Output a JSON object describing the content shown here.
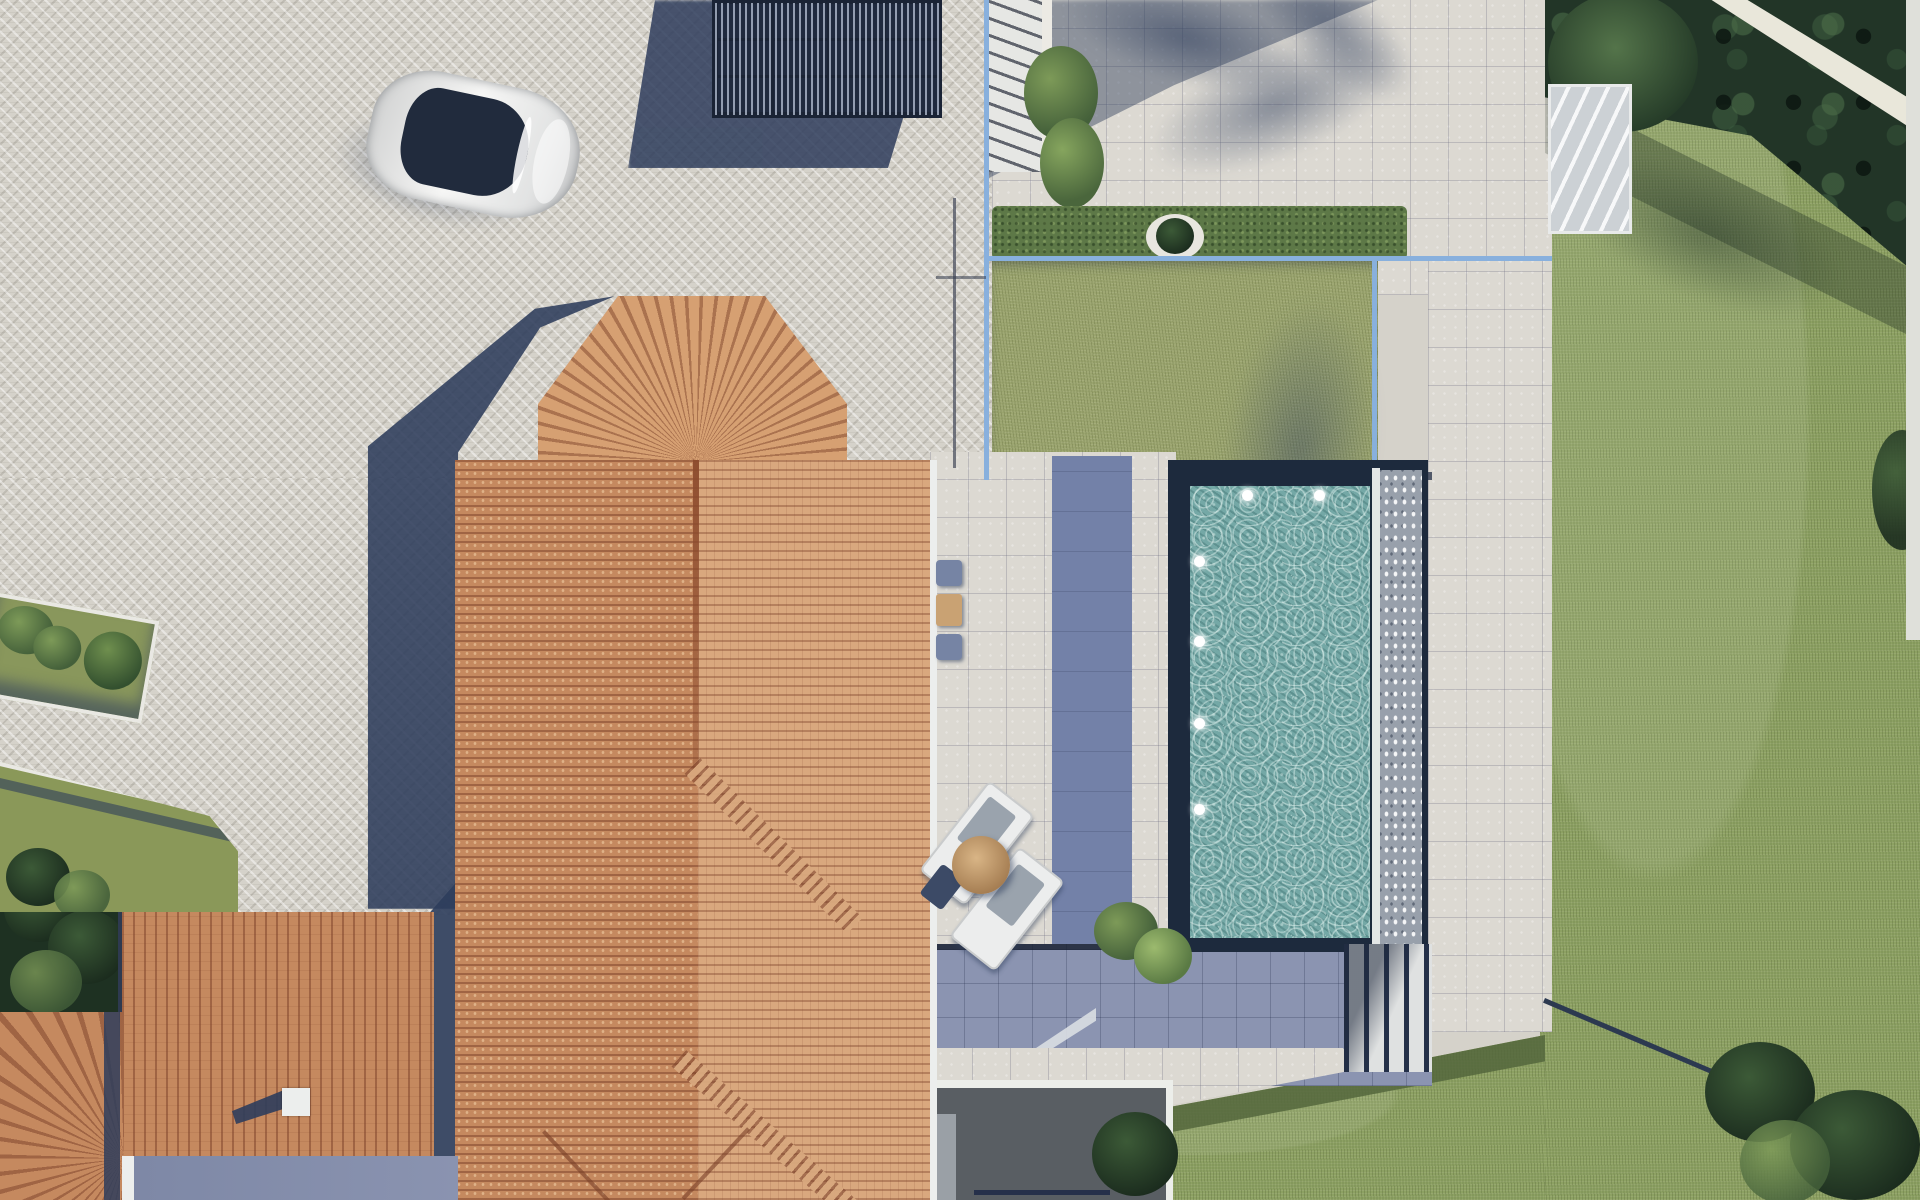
{
  "meta": {
    "type": "aerial-architectural-render",
    "view": "top-down bird's-eye plan view",
    "description": "Top-down 3D rendering of a Mediterranean villa: terracotta hip roofs with an octagonal bay, herringbone stone-paver driveway with a parked white car, a dark slatted rooftop pergola, upper tiled terrace behind a light-blue glass balustrade, central lawn, dark-framed lap pool with white underwater lights and an overflow deck, blue-grey lower terrace with sun loungers and a parasol, white garden stairs, surrounding lawns, clipped hedges, palm-tree shadows and a dense tree line along the right boundary.",
    "dimensions": {
      "width": 1920,
      "height": 1200
    }
  },
  "palette": {
    "paver": "#d5d2ca",
    "tile": "#dcd9d2",
    "grass": "#8da163",
    "lawn": "#9aa46e",
    "grass-dark": "#6f8150",
    "trees": "#223527",
    "hedge": "#5d7847",
    "roof": "#c5895f",
    "roof-light": "#d9a87e",
    "roof-rib": "#7a3f28",
    "pool-water": "#74a8a6",
    "pool-frame": "#1d2a3d",
    "fence": "#88b0dd",
    "terrace-blue": "#8b94b1",
    "deck-band": "#7381a8",
    "shadow": "#2e3d5c",
    "car-body": "#ebecec",
    "car-glass": "#212b3d",
    "pergola-dark": "#1f293e",
    "pergola-slat": "#97a2b8",
    "white": "#eceeed",
    "courtyard": "#595e63",
    "sand": "#c9a273"
  },
  "objects": {
    "scene": {
      "label": "Aerial view of a villa with pool, terraces and gardens"
    },
    "driveway": {
      "label": "Herringbone paver driveway"
    },
    "car": {
      "label": "White car parked on the driveway"
    },
    "pergola": {
      "label": "Dark slatted pergola / solar canopy"
    },
    "main_roof": {
      "label": "Main villa terracotta tile roof"
    },
    "bay_roof": {
      "label": "Octagonal bay roof with radiating tiles"
    },
    "guest_roof": {
      "label": "Lower building terracotta roof"
    },
    "corner_roof": {
      "label": "Corner hip roof with radiating tiles"
    },
    "chimney": {
      "label": "White rooftop chimney"
    },
    "top_terrace": {
      "label": "Upper tiled terrace with palm shadows"
    },
    "entry_stairs": {
      "label": "Entry staircase"
    },
    "balustrade": {
      "label": "Light-blue glass balustrade"
    },
    "hedge_strip": {
      "label": "Clipped hedge planter"
    },
    "lawn": {
      "label": "Central lawn"
    },
    "pool": {
      "label": "Lap pool with dark frame"
    },
    "pool_lights": {
      "label": "White underwater pool lights"
    },
    "overflow_deck": {
      "label": "Pool overflow edge deck"
    },
    "walkway": {
      "label": "Light tiled pool walkway"
    },
    "loungers": {
      "label": "Pair of white sun loungers"
    },
    "parasol": {
      "label": "Round tan parasol"
    },
    "bistro_set": {
      "label": "Small table and chairs"
    },
    "lower_terrace": {
      "label": "Blue-grey lower terrace"
    },
    "garden_stairs": {
      "label": "White garden steps"
    },
    "courtyard": {
      "label": "Sunken courtyard / lightwell"
    },
    "garden_right": {
      "label": "Large lawn along the right boundary"
    },
    "tree_line": {
      "label": "Dense tree and hedge line with boundary wall"
    },
    "planters": {
      "label": "Raised planters with shrubs and trees"
    },
    "side_pool": {
      "label": "Blue-grey side terrace strip"
    }
  }
}
